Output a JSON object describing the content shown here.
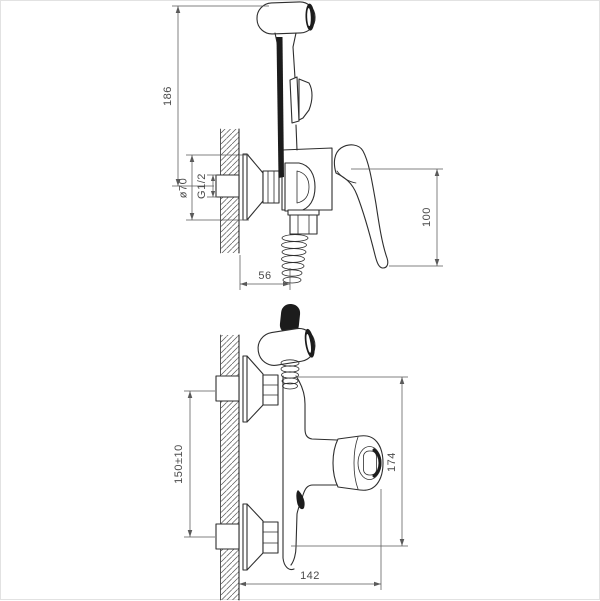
{
  "colors": {
    "line": "#2e2e2e",
    "dimension_line": "#5a5a5a",
    "dark_fill": "#1c1c1c",
    "background": "#ffffff",
    "frame": "#e2e2e2"
  },
  "dimensions": {
    "side_view": {
      "overall_height": "186",
      "flange_diameter": "ø70",
      "thread_size": "G1/2",
      "lever_height": "100",
      "wall_to_hose_axis": "56"
    },
    "front_view": {
      "inlet_spacing": "150±10",
      "overall_height": "174",
      "overall_width": "142"
    }
  }
}
